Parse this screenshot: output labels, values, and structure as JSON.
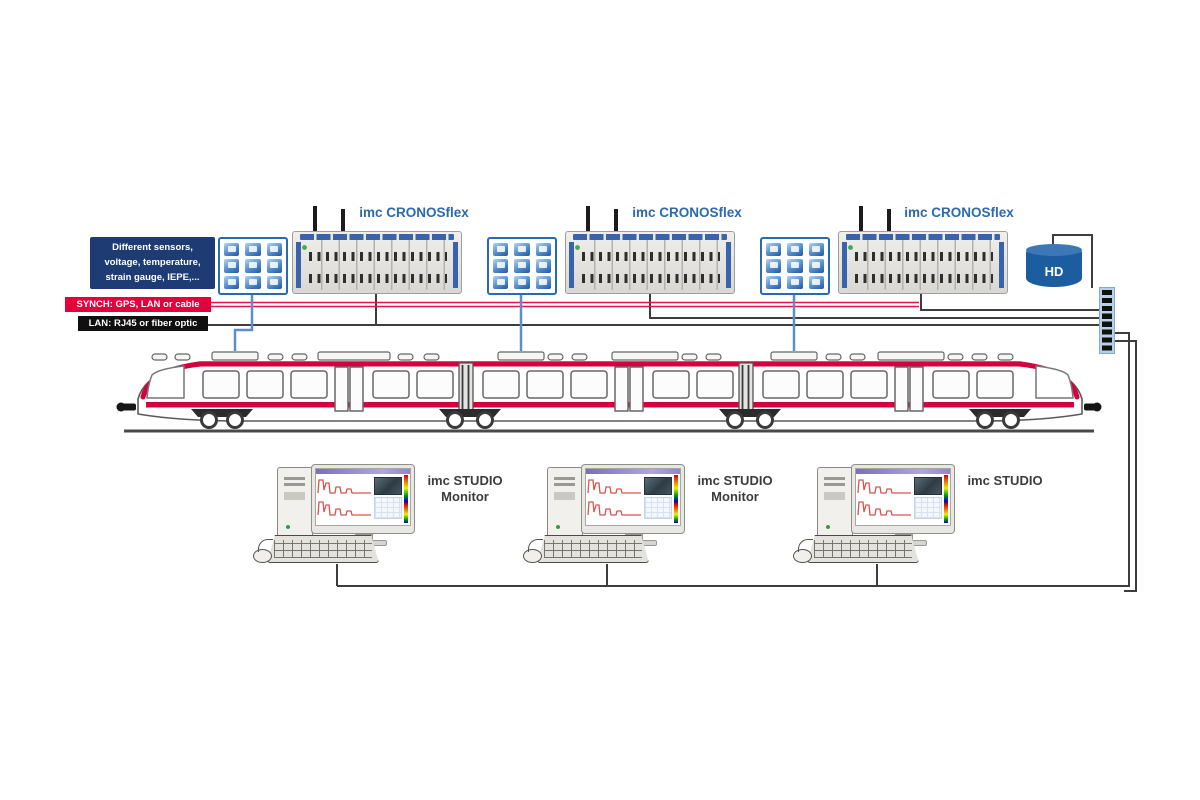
{
  "sensor_box": {
    "lines": [
      "Different sensors,",
      "voltage, temperature,",
      "strain gauge, IEPE,..."
    ]
  },
  "banners": {
    "synch": "SYNCH: GPS, LAN or cable",
    "lan": "LAN: RJ45 or fiber optic"
  },
  "devices": [
    {
      "label": "imc CRONOSflex"
    },
    {
      "label": "imc CRONOSflex"
    },
    {
      "label": "imc CRONOSflex"
    }
  ],
  "storage": {
    "label": "HD"
  },
  "workstations": [
    {
      "label_line1": "imc STUDIO",
      "label_line2": "Monitor"
    },
    {
      "label_line1": "imc STUDIO",
      "label_line2": "Monitor"
    },
    {
      "label_line1": "imc STUDIO",
      "label_line2": ""
    }
  ],
  "colors": {
    "label_blue": "#2a6ab1",
    "synch_red": "#e4003b",
    "lan_black": "#101010",
    "train_red": "#d60040",
    "line_blue": "#5b8fc9",
    "line_dark": "#3d3d3d",
    "info_navy": "#1e3c73",
    "hd_blue": "#1c5d9f"
  }
}
